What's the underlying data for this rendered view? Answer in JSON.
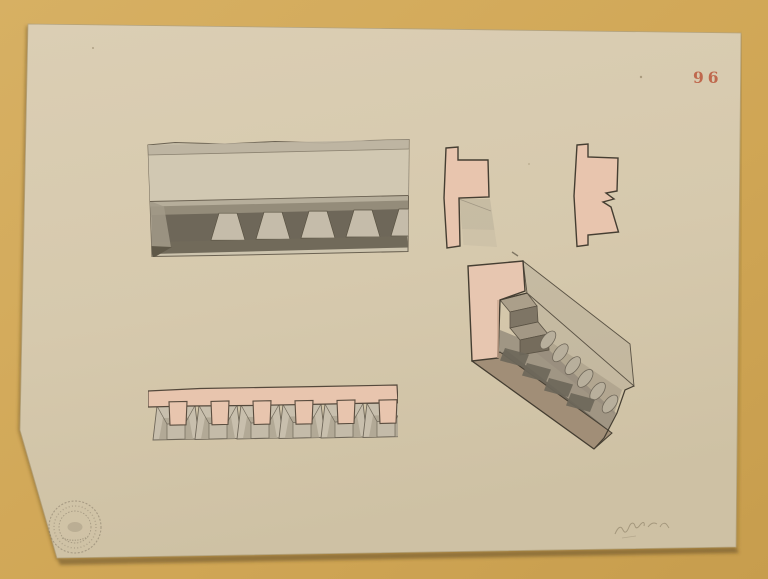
{
  "scene": {
    "background_color": "#d2a857",
    "kind": "archival architectural wash drawing photographed on a mustard background"
  },
  "paper": {
    "color": "#d7caaf",
    "page_number": "96",
    "page_number_color": "#bc5b40"
  },
  "views": {
    "elevation": {
      "label": "cornice-front-elevation",
      "dentil_count": 6
    },
    "profile_a": {
      "label": "cornice-section-profile"
    },
    "profile_b": {
      "label": "cornice-section-profile-with-dentil"
    },
    "soffit": {
      "label": "dentil-soffit-view",
      "square_count": 6,
      "stem_count": 6
    },
    "perspective": {
      "label": "cornice-perspective-view",
      "scallop_count": 6,
      "panel_count": 4
    }
  },
  "marks": {
    "stamp": {
      "label": "circular-collection-stamp",
      "legible": false
    },
    "handwriting": {
      "label": "handwritten-note",
      "legible": false
    }
  },
  "palette": {
    "ink": "#453e32",
    "pink_wash": "#e8c5ae",
    "gray_wash_light": "#c6bdab",
    "gray_wash_mid": "#948c7a",
    "gray_wash_dark": "#6e6759",
    "base_brown": "#a18e77"
  }
}
